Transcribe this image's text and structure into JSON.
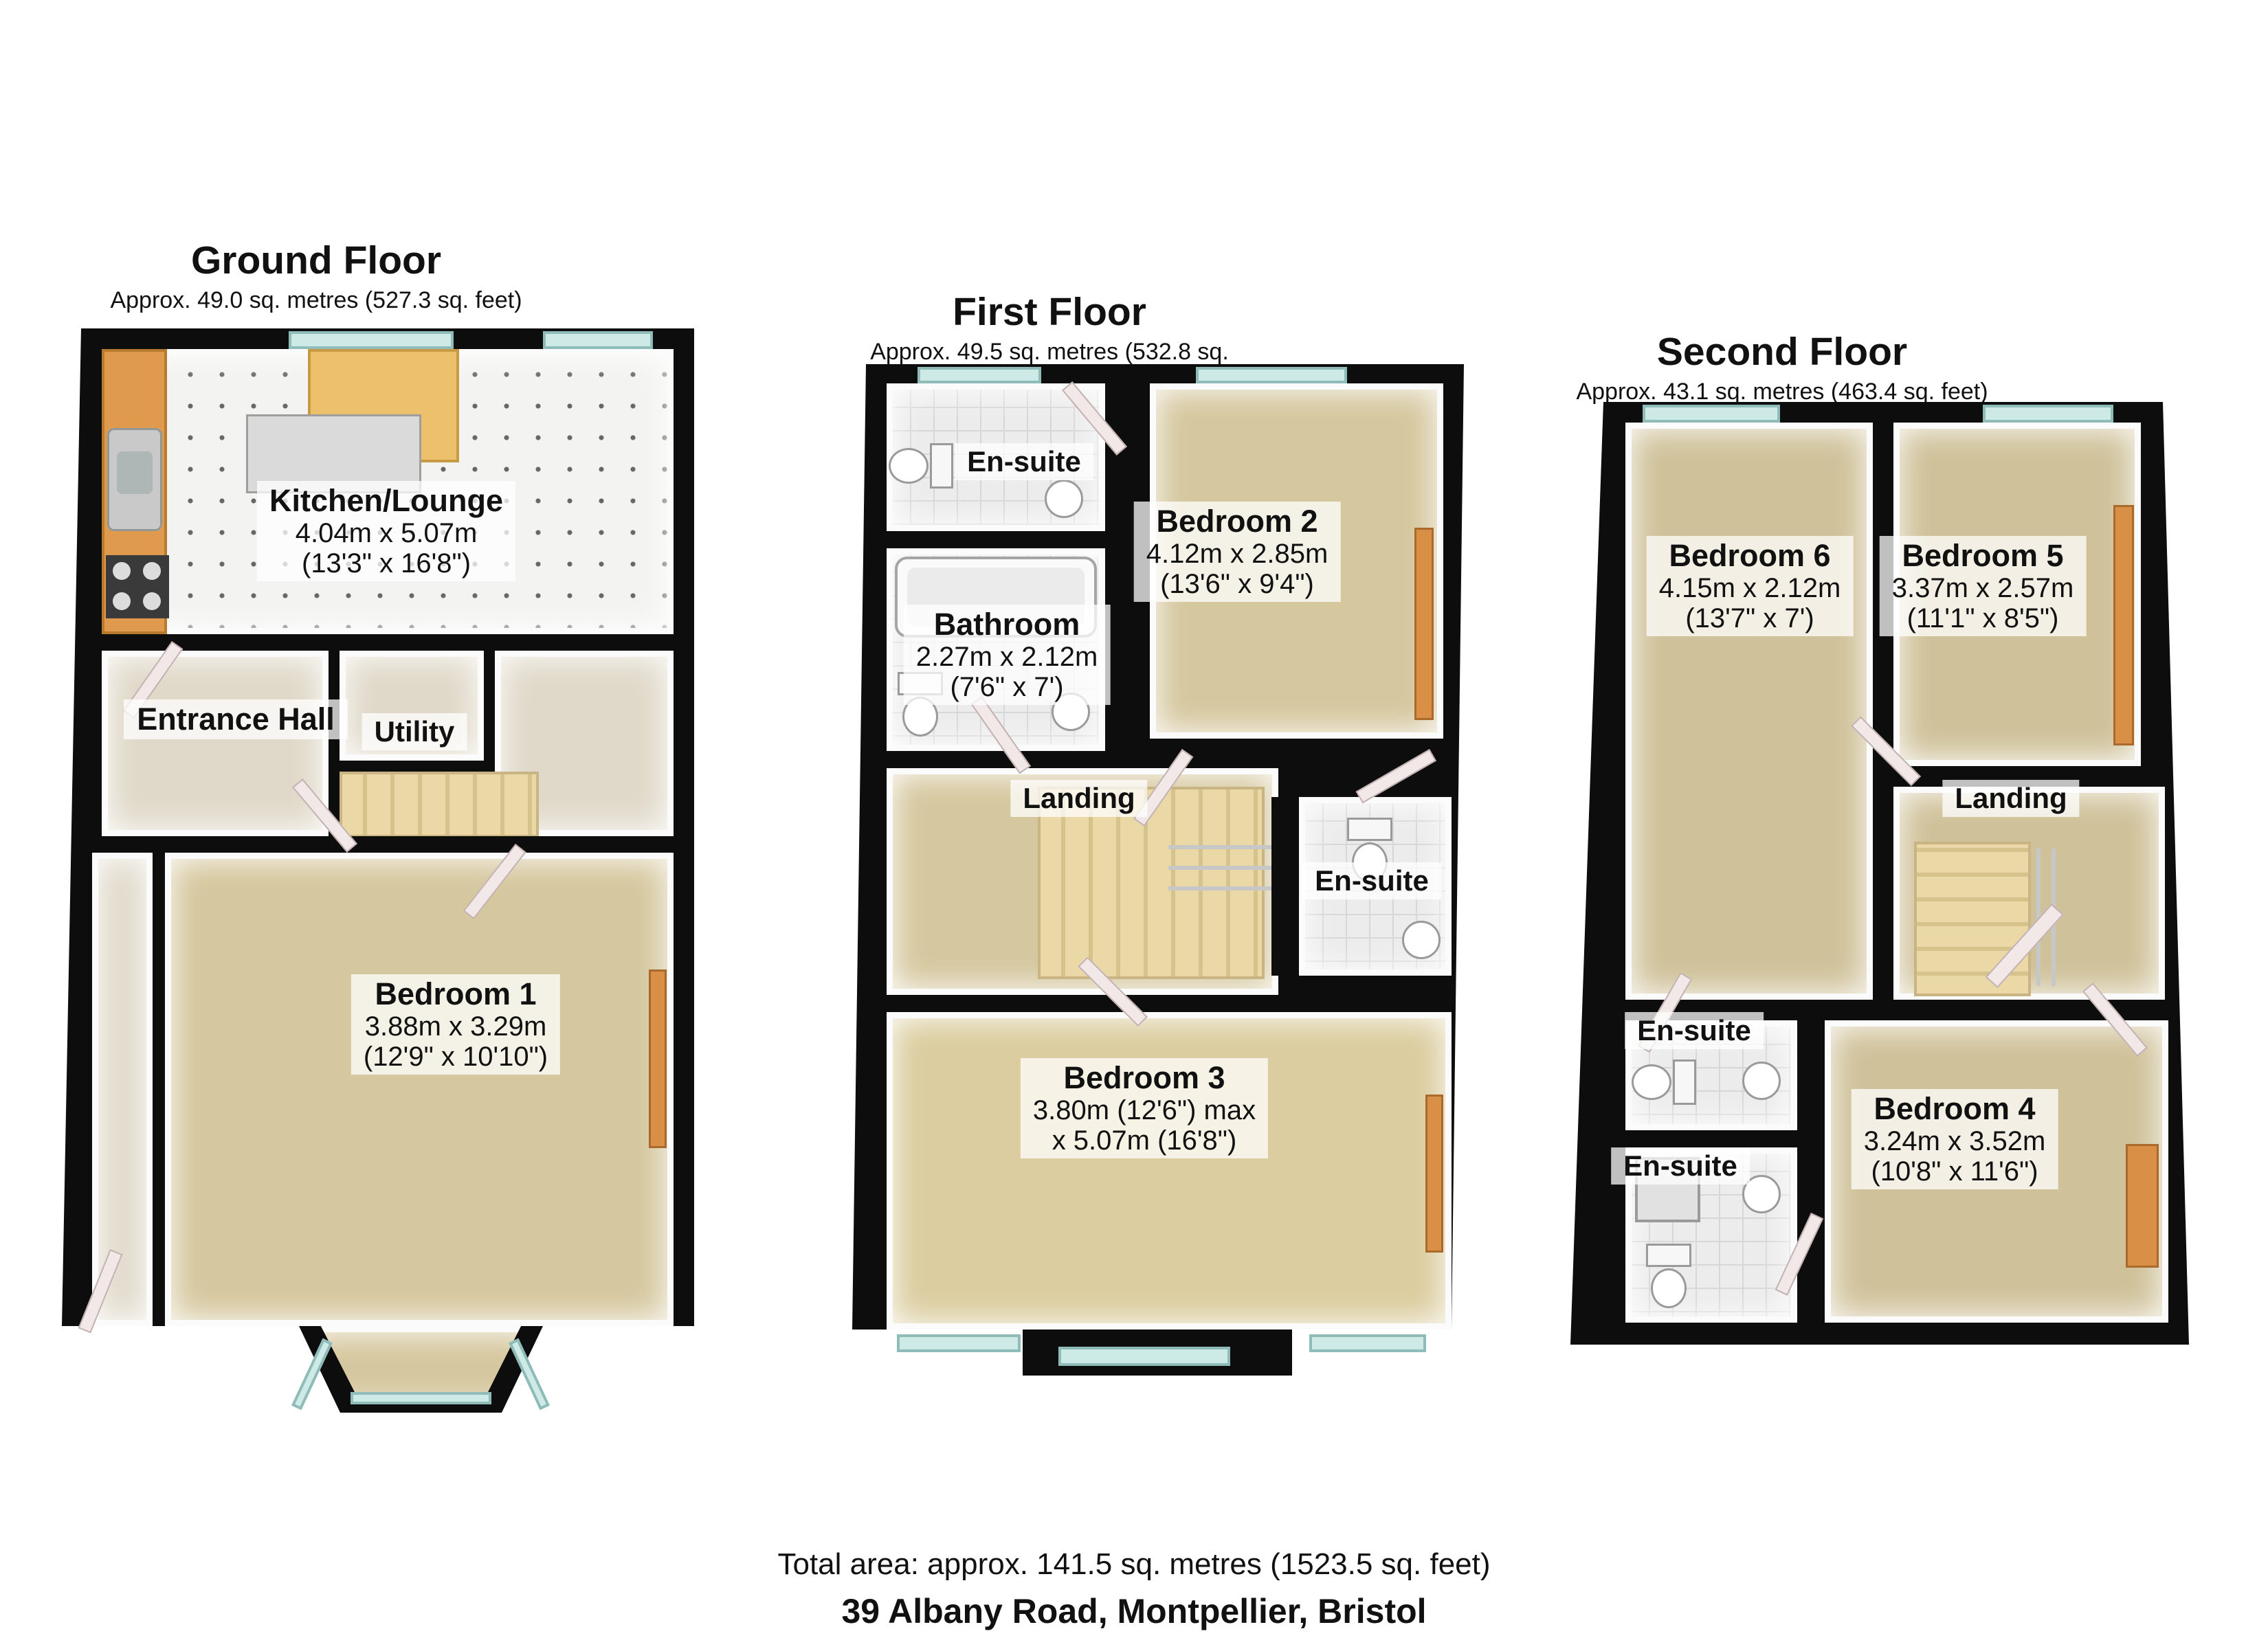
{
  "floors": [
    {
      "title": "Ground Floor",
      "subtitle": "Approx. 49.0 sq. metres (527.3 sq. feet)",
      "labels": {
        "kitchen": {
          "name": "Kitchen/Lounge",
          "m": "4.04m x 5.07m",
          "ft": "(13'3\" x 16'8\")"
        },
        "entrance": {
          "name": "Entrance Hall"
        },
        "utility": {
          "name": "Utility"
        },
        "bedroom1": {
          "name": "Bedroom 1",
          "m": "3.88m x 3.29m",
          "ft": "(12'9\" x 10'10\")"
        }
      }
    },
    {
      "title": "First Floor",
      "subtitle": "Approx. 49.5 sq. metres (532.8 sq. feet)",
      "labels": {
        "ensuite_top": {
          "name": "En-suite"
        },
        "bedroom2": {
          "name": "Bedroom 2",
          "m": "4.12m x 2.85m",
          "ft": "(13'6\" x 9'4\")"
        },
        "bathroom": {
          "name": "Bathroom",
          "m": "2.27m x 2.12m",
          "ft": "(7'6\" x 7')"
        },
        "landing": {
          "name": "Landing"
        },
        "ensuite_mid": {
          "name": "En-suite"
        },
        "bedroom3": {
          "name": "Bedroom 3",
          "m": "3.80m (12'6\") max",
          "ft": "x 5.07m (16'8\")"
        }
      }
    },
    {
      "title": "Second Floor",
      "subtitle": "Approx. 43.1 sq. metres (463.4 sq. feet)",
      "labels": {
        "bedroom6": {
          "name": "Bedroom 6",
          "m": "4.15m x 2.12m",
          "ft": "(13'7\" x 7')"
        },
        "bedroom5": {
          "name": "Bedroom 5",
          "m": "3.37m x 2.57m",
          "ft": "(11'1\" x 8'5\")"
        },
        "landing": {
          "name": "Landing"
        },
        "ensuite_mid": {
          "name": "En-suite"
        },
        "ensuite_low": {
          "name": "En-suite"
        },
        "bedroom4": {
          "name": "Bedroom 4",
          "m": "3.24m x 3.52m",
          "ft": "(10'8\" x 11'6\")"
        }
      }
    }
  ],
  "footer": {
    "total": "Total area: approx. 141.5 sq. metres (1523.5 sq. feet)",
    "address": "39 Albany Road, Montpellier, Bristol"
  },
  "colors": {
    "wall": "#0d0d0d",
    "carpet": "#d5c79e",
    "window_glass": "#cdeae6",
    "stairs": "#ead9a6",
    "wood_counter": "#e09a4e",
    "label_background": "rgba(255,255,255,0.74)"
  }
}
